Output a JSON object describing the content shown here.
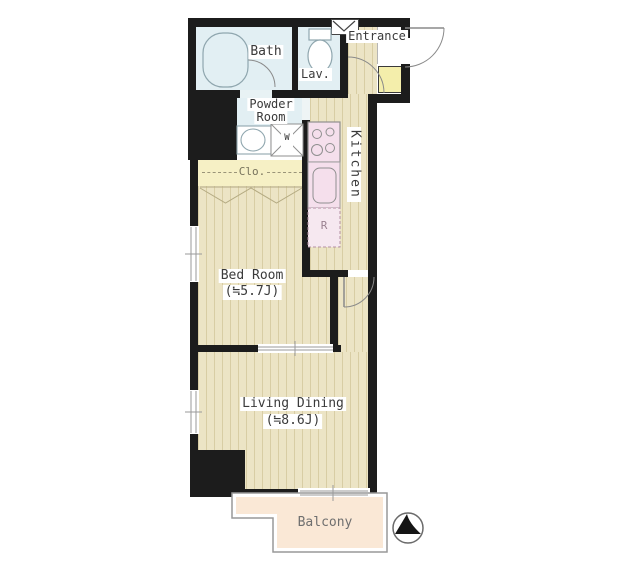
{
  "plan_title": "apartment-floor-plan",
  "rooms": {
    "bath": {
      "label": "Bath"
    },
    "lavatory": {
      "label": "Lav."
    },
    "entrance": {
      "label": "Entrance"
    },
    "powder": {
      "line1": "Powder",
      "line2": "Room",
      "washer_label": "W"
    },
    "kitchen": {
      "label": "Kitchen",
      "fridge_label": "R"
    },
    "closet": {
      "label": "Clo."
    },
    "bedroom": {
      "label": "Bed Room",
      "size": "(≒5.7J)"
    },
    "living": {
      "label": "Living Dining",
      "size": "(≒8.6J)"
    },
    "balcony": {
      "label": "Balcony"
    }
  },
  "icons": {
    "compass": "north-arrow-icon",
    "bathtub": "bathtub-icon",
    "toilet": "toilet-icon",
    "stove": "stove-icon",
    "sink": "sink-icon",
    "washbasin": "washbasin-icon",
    "washing_machine": "washing-machine-icon",
    "vent_window": "vent-window-icon"
  },
  "colors": {
    "wall": "#1c1c1c",
    "floor": "#ece4c5",
    "floor_stripe": "#d8cda4",
    "wet_area": "#e2eff3",
    "closet": "#f6f0c5",
    "kitchen_counter": "#f5dfec",
    "refrigerator": "#f6e8f0",
    "balcony": "#fae8d6",
    "shoe_cabinet": "#f4eeab"
  }
}
